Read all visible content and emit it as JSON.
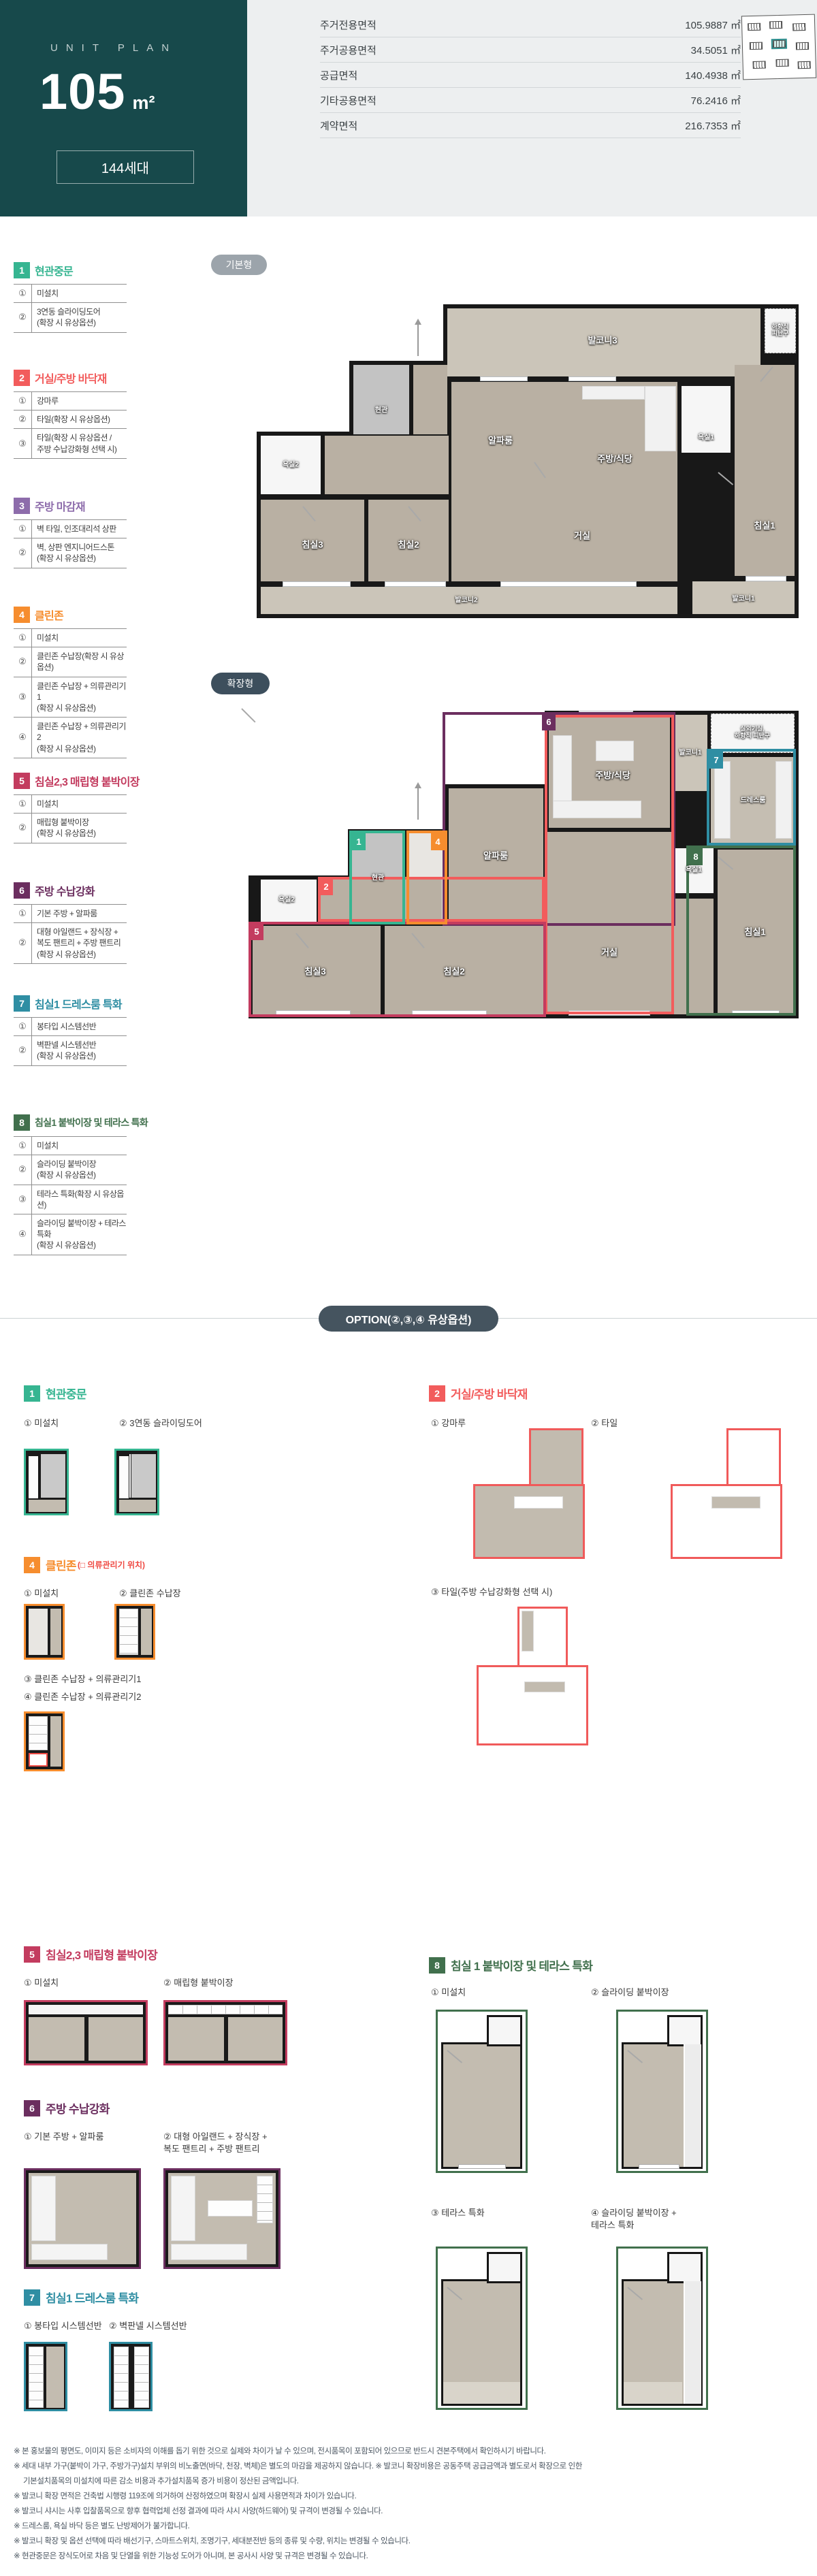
{
  "header": {
    "eyebrow": "UNIT PLAN",
    "size": "105",
    "unit": "m²",
    "household": "144세대"
  },
  "area_table": {
    "rows": [
      {
        "label": "주거전용면적",
        "value": "105.9887 ㎡"
      },
      {
        "label": "주거공용면적",
        "value": "34.5051 ㎡"
      },
      {
        "label": "공급면적",
        "value": "140.4938 ㎡"
      },
      {
        "label": "기타공용면적",
        "value": "76.2416 ㎡"
      },
      {
        "label": "계약면적",
        "value": "216.7353 ㎡"
      }
    ]
  },
  "plan_basic": {
    "badge": "기본형",
    "rooms": {
      "balcony3": "발코니3",
      "refuge": "하향식\n피난구",
      "entrance": "현관",
      "alpha": "알파룸",
      "kitchen": "주방/식당",
      "bath1": "욕실1",
      "bath2": "욕실2",
      "bed3": "침실3",
      "bed2": "침실2",
      "living": "거실",
      "bed1": "침실1",
      "balcony2": "발코니2",
      "balcony1": "발코니1"
    }
  },
  "plan_ext": {
    "badge": "확장형",
    "rooms": {
      "kitchen": "주방/식당",
      "balcony1": "발코니1",
      "outdoor": "실외기실,\n하향식 피난구",
      "dress": "드레스룸",
      "bath1": "욕실1",
      "entrance": "현관",
      "alpha": "알파룸",
      "bath2": "욕실2",
      "bed3": "침실3",
      "bed2": "침실2",
      "living": "거실",
      "bed1": "침실1"
    },
    "markers": {
      "m1": "1",
      "m2": "2",
      "m4": "4",
      "m5": "5",
      "m6": "6",
      "m7": "7",
      "m8": "8"
    }
  },
  "colors": {
    "s1": "#36b591",
    "s2": "#f25c5c",
    "s3": "#8d6cab",
    "s4": "#f68d2e",
    "s5": "#c33c5f",
    "s6": "#6b2e5f",
    "s7": "#2f8ea3",
    "s8": "#41704d",
    "hero": "#17494b",
    "pill_basic": "#9ca4ab",
    "pill_ext": "#3d4f5d",
    "option_pill": "#45545f"
  },
  "sidebar": {
    "sections": [
      {
        "num": "1",
        "title": "현관중문",
        "rows": [
          {
            "no": "①",
            "text": "미설치"
          },
          {
            "no": "②",
            "text": "3연동 슬라이딩도어\n(확장 시 유상옵션)"
          }
        ]
      },
      {
        "num": "2",
        "title": "거실/주방 바닥재",
        "rows": [
          {
            "no": "①",
            "text": "강마루"
          },
          {
            "no": "②",
            "text": "타일(확장 시 유상옵션)"
          },
          {
            "no": "③",
            "text": "타일(확장 시 유상옵션 /\n주방 수납강화형 선택 시)"
          }
        ]
      },
      {
        "num": "3",
        "title": "주방 마감재",
        "rows": [
          {
            "no": "①",
            "text": "벽 타일, 인조대리석 상판"
          },
          {
            "no": "②",
            "text": "벽, 상판 엔지니어드스톤\n(확장 시 유상옵션)"
          }
        ]
      },
      {
        "num": "4",
        "title": "클린존",
        "rows": [
          {
            "no": "①",
            "text": "미설치"
          },
          {
            "no": "②",
            "text": "클린존 수납장(확장 시 유상옵션)"
          },
          {
            "no": "③",
            "text": "클린존 수납장 + 의류관리기1\n(확장 시 유상옵션)"
          },
          {
            "no": "④",
            "text": "클린존 수납장 + 의류관리기 2\n(확장 시 유상옵션)"
          }
        ]
      },
      {
        "num": "5",
        "title": "침실2,3 매립형 붙박이장",
        "rows": [
          {
            "no": "①",
            "text": "미설치"
          },
          {
            "no": "②",
            "text": "매립형 붙박이장\n(확장 시 유상옵션)"
          }
        ]
      },
      {
        "num": "6",
        "title": "주방 수납강화",
        "rows": [
          {
            "no": "①",
            "text": "기본 주방 + 알파룸"
          },
          {
            "no": "②",
            "text": "대형 아일랜드 + 장식장 +\n복도 팬트리 + 주방 팬트리\n(확장 시 유상옵션)"
          }
        ]
      },
      {
        "num": "7",
        "title": "침실1 드레스룸 특화",
        "rows": [
          {
            "no": "①",
            "text": "봉타입 시스템선반"
          },
          {
            "no": "②",
            "text": "벽판넬 시스템선반\n(확장 시 유상옵션)"
          }
        ]
      },
      {
        "num": "8",
        "title": "침실1 붙박이장 및 테라스 특화",
        "rows": [
          {
            "no": "①",
            "text": "미설치"
          },
          {
            "no": "②",
            "text": "슬라이딩 붙박이장\n(확장 시 유상옵션)"
          },
          {
            "no": "③",
            "text": "테라스 특화(확장 시 유상옵션)"
          },
          {
            "no": "④",
            "text": "슬라이딩 붙박이장 + 테라스 특화\n(확장 시 유상옵션)"
          }
        ]
      }
    ]
  },
  "option": {
    "banner": "OPTION(②,③,④ 유상옵션)",
    "s1": {
      "num": "1",
      "title": "현관중문",
      "items": [
        "① 미설치",
        "② 3연동 슬라이딩도어"
      ]
    },
    "s2": {
      "num": "2",
      "title": "거실/주방 바닥재",
      "items": [
        "① 강마루",
        "② 타일",
        "③ 타일(주방 수납강화형 선택 시)"
      ]
    },
    "s4": {
      "num": "4",
      "title": "클린존",
      "suffix": "(□ 의류관리기 위치)",
      "items": [
        "① 미설치",
        "② 클린존 수납장",
        "③ 클린존 수납장 + 의류관리기1",
        "④ 클린존 수납장 + 의류관리기2"
      ]
    },
    "s5": {
      "num": "5",
      "title": "침실2,3 매립형 붙박이장",
      "items": [
        "① 미설치",
        "② 매립형 붙박이장"
      ]
    },
    "s6": {
      "num": "6",
      "title": "주방 수납강화",
      "items": [
        "① 기본 주방 + 알파룸",
        "② 대형 아일랜드 + 장식장 +\n복도 팬트리 + 주방 팬트리"
      ]
    },
    "s7": {
      "num": "7",
      "title": "침실1 드레스룸 특화",
      "items": [
        "① 봉타입 시스템선반",
        "② 벽판넬 시스템선반"
      ]
    },
    "s8": {
      "num": "8",
      "title": "침실 1 붙박이장 및 테라스 특화",
      "items": [
        "① 미설치",
        "② 슬라이딩 붙박이장",
        "③ 테라스 특화",
        "④ 슬라이딩 붙박이장 +\n테라스 특화"
      ]
    }
  },
  "footnotes": [
    "※ 본 홍보물의 평면도, 이미지 등은 소비자의 이해를 돕기 위한 것으로 실제와 차이가 날 수 있으며, 전시품목이 포함되어 있으므로 반드시 견본주택에서 확인하시기 바랍니다.",
    "※ 세대 내부 가구(붙박이 가구, 주방가구)설치 부위의 비노출면(바닥, 천장, 벽체)은 별도의 마감을 제공하지 않습니다. ※ 발코니 확장비용은 공동주택 공급금액과 별도로서 확장으로 인한",
    "기본설치품목의 미설치에 따른 감소 비용과 추가설치품목 증가 비용이 정산된 금액입니다.",
    "※ 발코니 확장 면적은 건축법 시행령 119조에 의거하여 산정하였으며 확장시 실제 사용면적과 차이가 있습니다.",
    "※ 발코니 샤시는 사후 입찰품목으로 향후 협력업체 선정 결과에 따라 샤시 사양(하드웨어) 및 규격이 변경될 수 있습니다.",
    "※ 드레스룸, 욕실 바닥 등은 별도 난방제어가 불가합니다.",
    "※ 발코니 확장 및 옵션 선택에 따라 배선기구, 스마트스위치, 조명기구, 세대분전반 등의 종류 및 수량, 위치는 변경될 수 있습니다.",
    "※ 현관중문은 장식도어로 차음 및 단열을 위한 기능성 도어가 아니며, 본 공사시 사양 및 규격은 변경될 수 있습니다."
  ]
}
